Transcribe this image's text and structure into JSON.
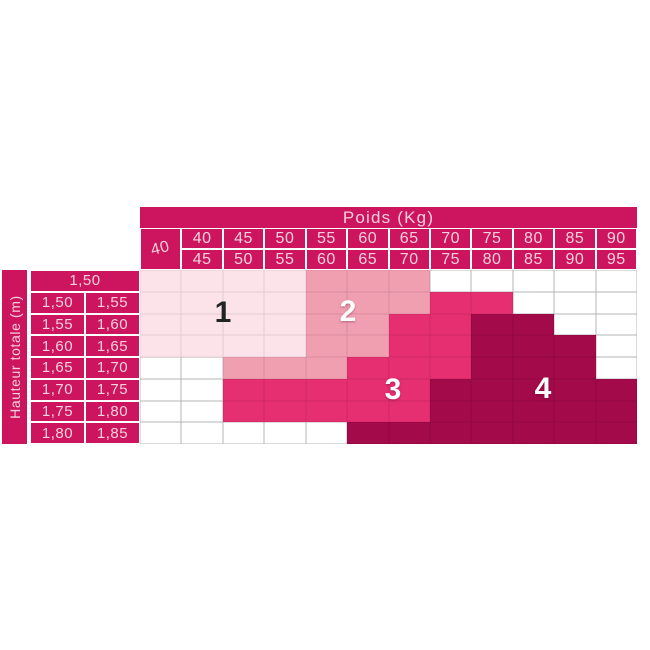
{
  "table": {
    "weight_header": "Poids (Kg)",
    "height_header": "Hauteur totale (m)",
    "corner_weight": "40",
    "weight_ranges": [
      [
        "40",
        "45"
      ],
      [
        "45",
        "50"
      ],
      [
        "50",
        "55"
      ],
      [
        "55",
        "60"
      ],
      [
        "60",
        "65"
      ],
      [
        "65",
        "70"
      ],
      [
        "70",
        "75"
      ],
      [
        "75",
        "80"
      ],
      [
        "80",
        "85"
      ],
      [
        "85",
        "90"
      ],
      [
        "90",
        "95"
      ]
    ],
    "height_first_row": "1,50",
    "height_ranges": [
      [
        "1,50",
        "1,55"
      ],
      [
        "1,55",
        "1,60"
      ],
      [
        "1,60",
        "1,65"
      ],
      [
        "1,65",
        "1,70"
      ],
      [
        "1,70",
        "1,75"
      ],
      [
        "1,75",
        "1,80"
      ],
      [
        "1,80",
        "1,85"
      ]
    ]
  },
  "zones": [
    {
      "id": 1,
      "label": "1",
      "color": "#fbe3e9",
      "text_color": "#232326"
    },
    {
      "id": 2,
      "label": "2",
      "color": "#f09fb1",
      "text_color": "#ffffff"
    },
    {
      "id": 3,
      "label": "3",
      "color": "#e62f70",
      "text_color": "#ffffff"
    },
    {
      "id": 4,
      "label": "4",
      "color": "#a30a4a",
      "text_color": "#ffffff"
    }
  ],
  "colors": {
    "header_bg": "#cc155e",
    "header_text": "#f6d0dd",
    "grid_line": "#b5b5b5"
  },
  "chart_data": {
    "type": "heatmap",
    "title": "Poids (Kg)",
    "xlabel": "Poids (Kg)",
    "ylabel": "Hauteur totale (m)",
    "x_categories": [
      "40",
      "40-45",
      "45-50",
      "50-55",
      "55-60",
      "60-65",
      "65-70",
      "70-75",
      "75-80",
      "80-85",
      "85-90",
      "90-95"
    ],
    "y_categories": [
      "1,50",
      "1,50-1,55",
      "1,55-1,60",
      "1,60-1,65",
      "1,65-1,70",
      "1,70-1,75",
      "1,75-1,80",
      "1,80-1,85"
    ],
    "legend": [
      "1",
      "2",
      "3",
      "4"
    ],
    "values": [
      [
        1,
        1,
        1,
        1,
        2,
        2,
        2,
        0,
        0,
        0,
        0,
        0
      ],
      [
        1,
        1,
        1,
        1,
        2,
        2,
        2,
        3,
        3,
        0,
        0,
        0
      ],
      [
        1,
        1,
        1,
        1,
        2,
        2,
        3,
        3,
        4,
        4,
        0,
        0
      ],
      [
        1,
        1,
        1,
        1,
        2,
        2,
        3,
        3,
        4,
        4,
        4,
        0
      ],
      [
        0,
        0,
        2,
        2,
        2,
        3,
        3,
        3,
        4,
        4,
        4,
        0
      ],
      [
        0,
        0,
        3,
        3,
        3,
        3,
        3,
        4,
        4,
        4,
        4,
        4
      ],
      [
        0,
        0,
        3,
        3,
        3,
        3,
        3,
        4,
        4,
        4,
        4,
        4
      ],
      [
        0,
        0,
        0,
        0,
        0,
        4,
        4,
        4,
        4,
        4,
        4,
        4
      ]
    ]
  }
}
